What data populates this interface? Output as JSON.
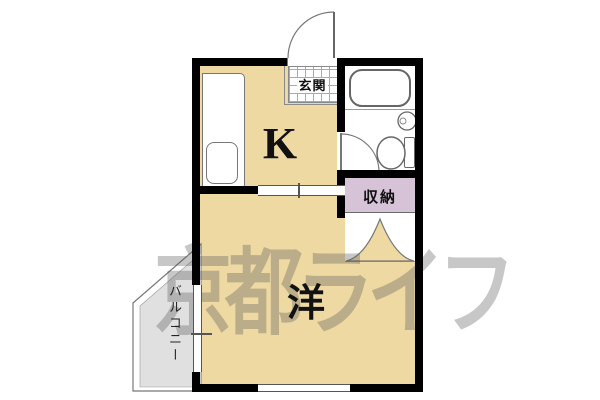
{
  "floor_plan": {
    "type": "apartment-floor-plan",
    "watermark": {
      "text": "京都ライフ",
      "color": "#8a8a8a"
    },
    "rooms": {
      "kitchen": {
        "label": "K"
      },
      "western_room": {
        "label": "洋"
      },
      "entrance": {
        "label": "玄関"
      },
      "storage": {
        "label": "収納"
      },
      "balcony": {
        "label": "バルコニー"
      }
    },
    "fixtures": [
      "entrance-swing-door",
      "bathtub",
      "washbasin",
      "toilet",
      "bathroom-swing-door",
      "kitchen-counter",
      "kitchen-sink",
      "closet-double-door",
      "sliding-partition",
      "balcony-sliding-window",
      "bottom-window"
    ],
    "colors": {
      "room_fill": "#eed9a3",
      "storage_fill": "#d6c3d8",
      "balcony_fill": "#e0e0e0",
      "wall": "#000000",
      "thin_line": "#777777"
    }
  }
}
